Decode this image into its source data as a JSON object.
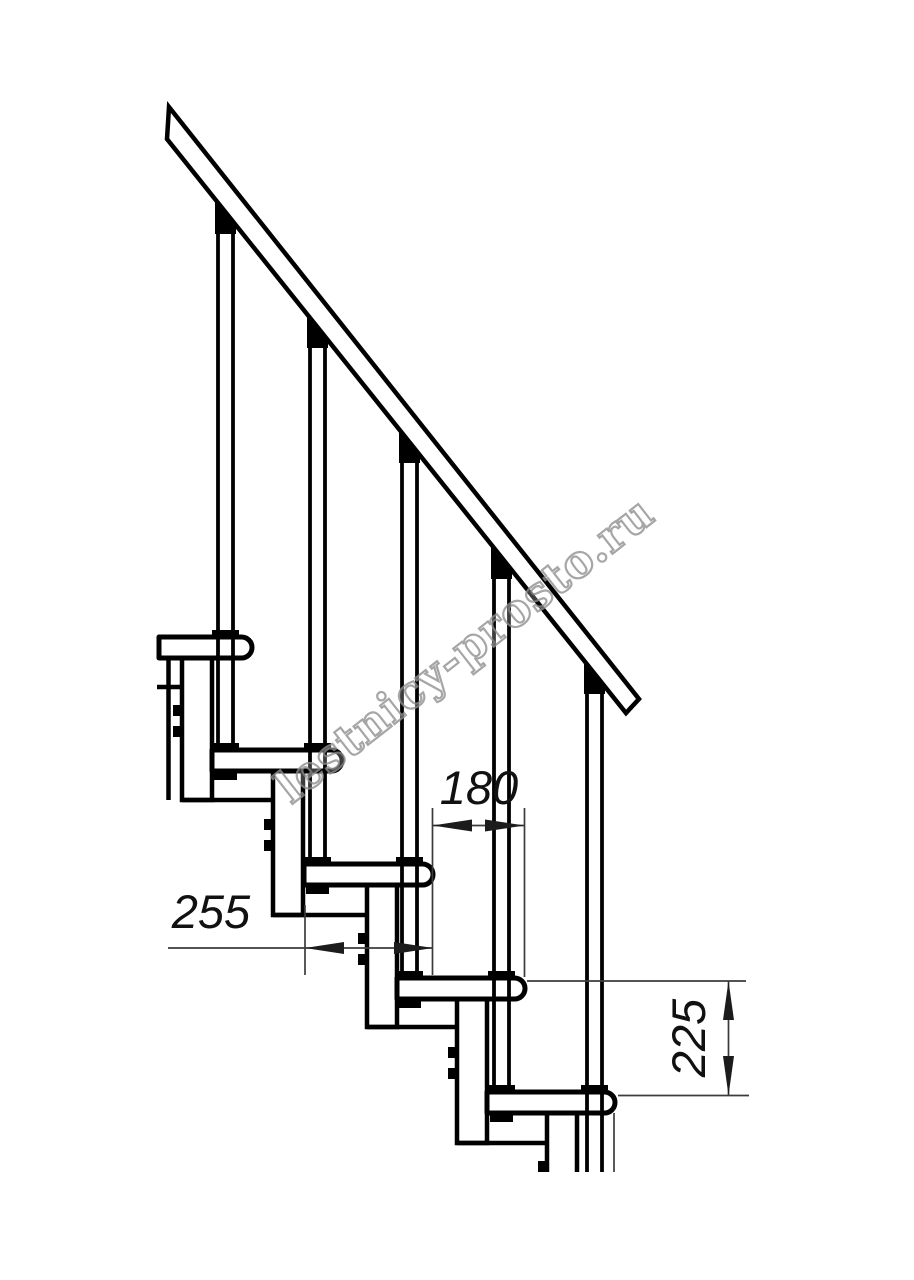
{
  "drawing": {
    "title": "Modular staircase side elevation drawing",
    "dimensions": {
      "step_depth_label": "180",
      "step_run_label": "255",
      "riser_height_label": "225"
    },
    "watermark": "lestnicy-prosto.ru",
    "structure": {
      "treads_visible": 5,
      "balusters_visible": 5,
      "support_columns_visible": 5,
      "handrail": true
    },
    "colors": {
      "line": "#000000",
      "dimension_line": "#3c3c3c",
      "dimension_text": "#111111",
      "watermark_outline": "#909090",
      "background": "#ffffff"
    }
  }
}
